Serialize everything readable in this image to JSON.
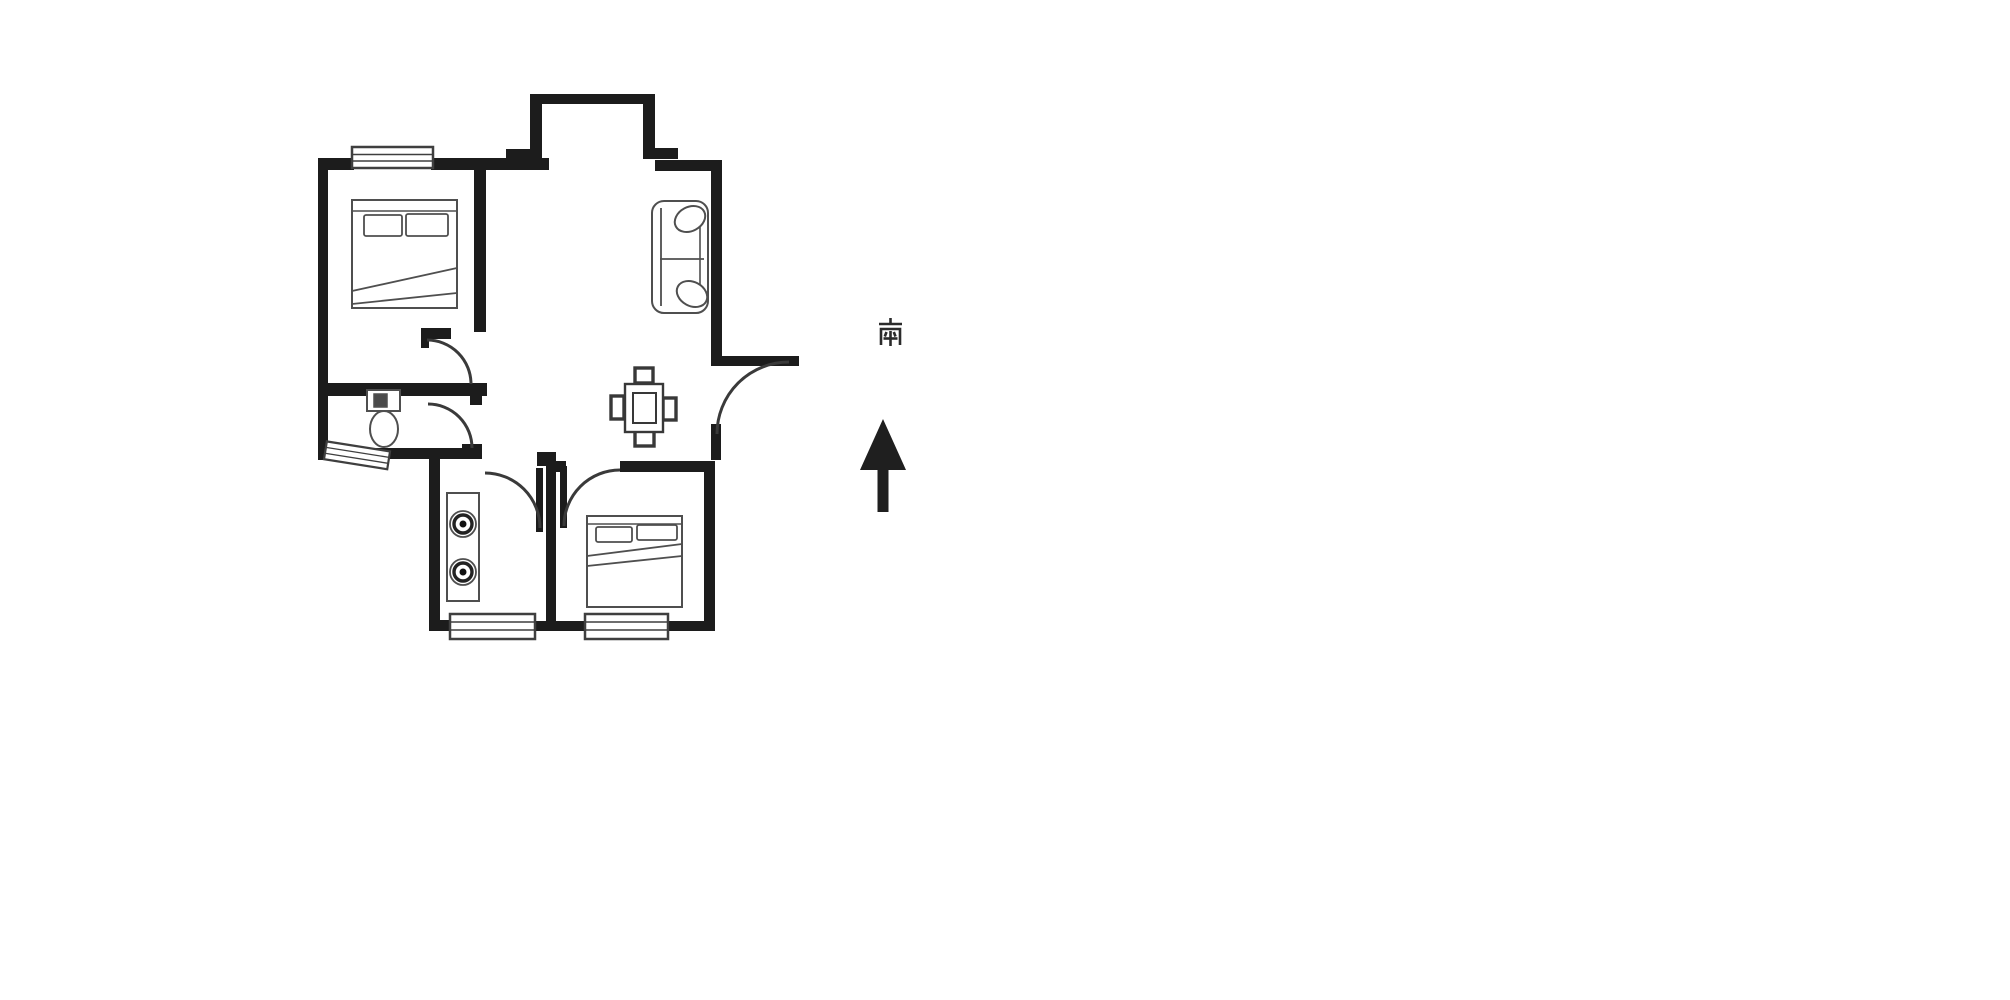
{
  "page": {
    "background_color": "#ffffff"
  },
  "compass": {
    "label": "南",
    "arrow_direction": "up",
    "ink_color": "#1f1f1f"
  },
  "floor_plan": {
    "wall_color": "#1c1c1c",
    "door_arc_color": "#3a3a3a",
    "furniture_line_color": "#4f4f4f",
    "window_frame_color": "#3f3f3f",
    "windows": [
      "main-bedroom-top-window",
      "bathroom-bottom-window",
      "kitchen-bottom-window",
      "second-bedroom-bottom-window"
    ],
    "doors": [
      "main-bedroom-door",
      "bathroom-door",
      "kitchen-door",
      "second-bedroom-door",
      "entry-door"
    ],
    "furniture": [
      "double-bed-icon",
      "sofa-icon",
      "toilet-icon",
      "dining-table-icon",
      "gas-stove-icon",
      "double-bed-icon"
    ],
    "features": [
      "bay-balcony"
    ]
  }
}
